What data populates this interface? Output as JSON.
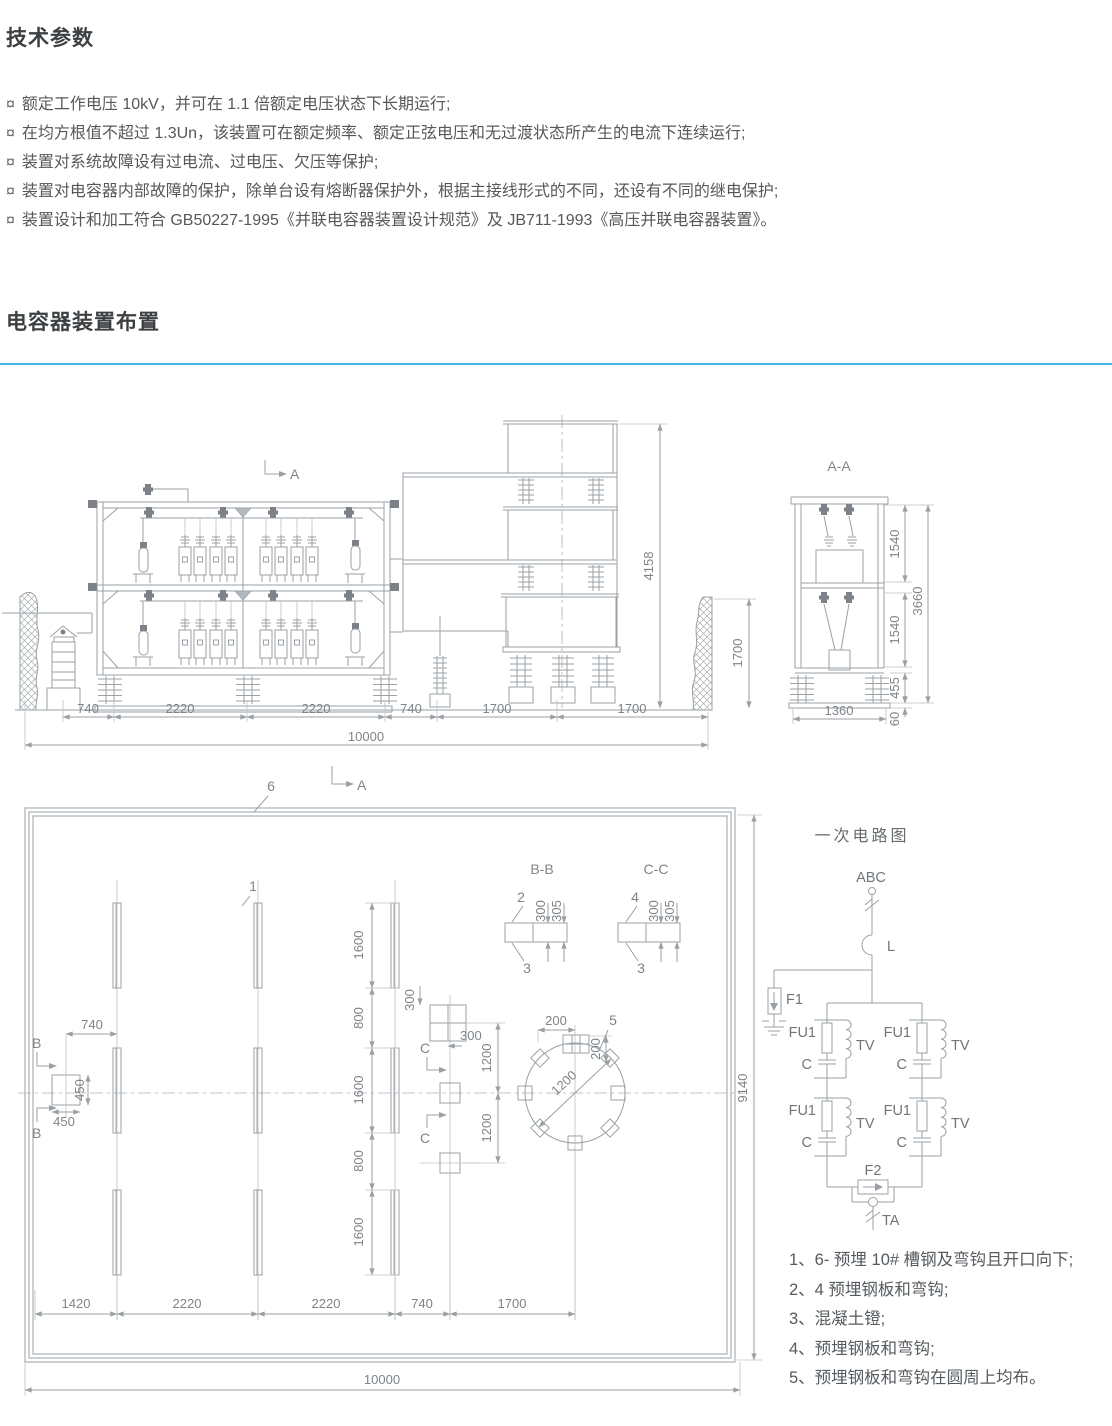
{
  "page": {
    "tech": {
      "title": "技术参数",
      "bullet_marker": "¤",
      "bullets": [
        "额定工作电压 10kV，并可在 1.1 倍额定电压状态下长期运行;",
        "在均方根值不超过 1.3Un，该装置可在额定频率、额定正弦电压和无过渡状态所产生的电流下连续运行;",
        "装置对系统故障设有过电流、过电压、欠压等保护;",
        "装置对电容器内部故障的保护，除单台设有熔断器保护外，根据主接线形式的不同，还设有不同的继电保护;",
        "装置设计和加工符合 GB50227-1995《并联电容器装置设计规范》及 JB711-1993《高压并联电容器装置》。"
      ]
    },
    "layout": {
      "title": "电容器装置布置",
      "accent_color": "#3fb4e4"
    }
  },
  "dwg": {
    "elevation": {
      "marker_top": "A",
      "marker_bottom": "A",
      "dims_bottom": [
        "740",
        "2220",
        "2220",
        "740",
        "1700",
        "1700"
      ],
      "dim_total": "10000",
      "dim_height": "4158",
      "dim_wall_height": "1700"
    },
    "section_aa": {
      "title": "A-A",
      "dim_tier1": "1540",
      "dim_tier2": "1540",
      "dim_total": "3660",
      "dim_insulator": "455",
      "dim_base": "60",
      "dim_width": "1360"
    },
    "plan": {
      "callout_6": "6",
      "callout_1": "1",
      "callout_5": "5",
      "marker_b": "B",
      "marker_c": "C",
      "dims_chain": [
        "1600",
        "800",
        "1600",
        "800",
        "1600"
      ],
      "dims_bottom": [
        "1420",
        "2220",
        "2220",
        "740",
        "1700"
      ],
      "dim_total": "10000",
      "dim_height": "9140",
      "dim_740": "740",
      "dim_450_v": "450",
      "dim_450_h": "450",
      "dim_300_v": "300",
      "dim_300_h": "300",
      "dim_1200_a": "1200",
      "dim_1200_b": "1200",
      "circle_dia": "1200",
      "circle_off_h": "200",
      "circle_off_v": "200"
    },
    "detail_bb": {
      "title": "B-B",
      "callout_top": "2",
      "callout_bottom": "3",
      "dim_a": "300",
      "dim_b": "305"
    },
    "detail_cc": {
      "title": "C-C",
      "callout_top": "4",
      "callout_bottom": "3",
      "dim_a": "300",
      "dim_b": "305"
    },
    "circuit": {
      "title": "一次电路图",
      "bus": "ABC",
      "inductor": "L",
      "arrester_f1": "F1",
      "fuse": "FU1",
      "vt": "TV",
      "capacitor": "C",
      "arrester_f2": "F2",
      "ct": "TA"
    }
  },
  "notes": {
    "items": [
      "1、6- 预埋 10# 槽钢及弯钩且开口向下;",
      "2、4 预埋钢板和弯钩;",
      "3、混凝土镫;",
      "4、预埋钢板和弯钩;",
      "5、预埋钢板和弯钩在圆周上均布。"
    ]
  }
}
